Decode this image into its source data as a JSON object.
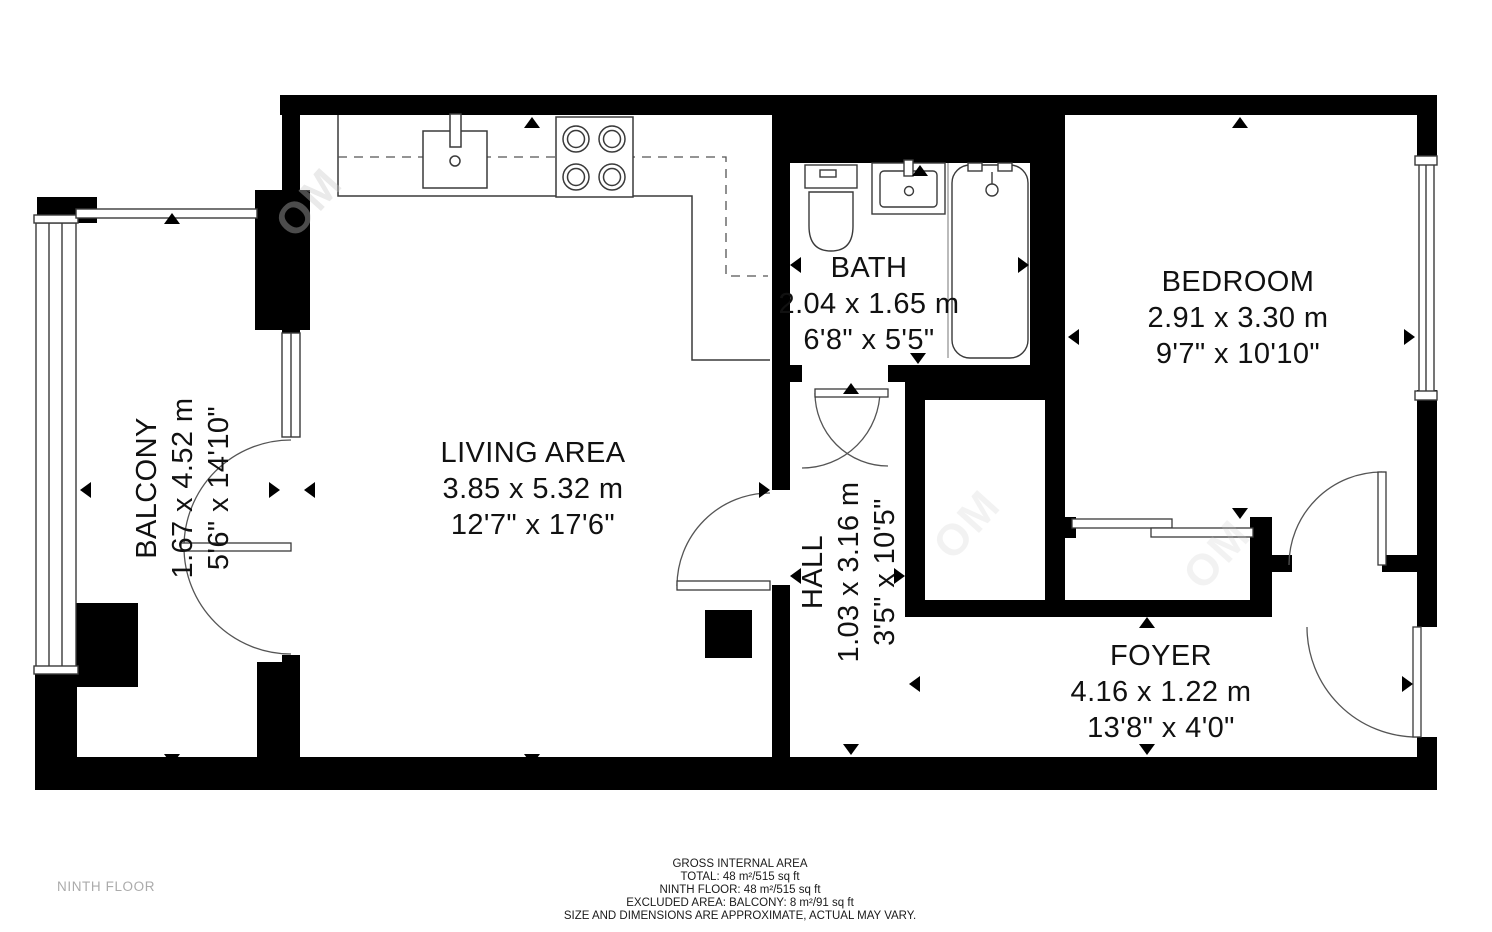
{
  "floor_label": "NINTH FLOOR",
  "watermark": {
    "text": "OM"
  },
  "rooms": {
    "living": {
      "name": "LIVING AREA",
      "metric": "3.85 x 5.32 m",
      "imperial": "12'7\" x 17'6\""
    },
    "balcony": {
      "name": "BALCONY",
      "metric": "1.67 x 4.52 m",
      "imperial": "5'6\" x 14'10\""
    },
    "bath": {
      "name": "BATH",
      "metric": "2.04 x 1.65 m",
      "imperial": "6'8\" x 5'5\""
    },
    "bedroom": {
      "name": "BEDROOM",
      "metric": "2.91 x 3.30 m",
      "imperial": "9'7\" x 10'10\""
    },
    "hall": {
      "name": "HALL",
      "metric": "1.03 x 3.16 m",
      "imperial": "3'5\" x 10'5\""
    },
    "foyer": {
      "name": "FOYER",
      "metric": "4.16 x 1.22 m",
      "imperial": "13'8\" x 4'0\""
    }
  },
  "footer": {
    "line1": "GROSS INTERNAL AREA",
    "line2": "TOTAL: 48 m²/515 sq ft",
    "line3": "NINTH FLOOR: 48 m²/515 sq ft",
    "line4": "EXCLUDED AREA: BALCONY: 8 m²/91 sq ft",
    "line5": "SIZE AND DIMENSIONS ARE APPROXIMATE, ACTUAL MAY VARY."
  },
  "colors": {
    "wall": "#000000",
    "fixture_line": "#3a3a3a",
    "label": "#111111",
    "muted": "#ababab"
  }
}
